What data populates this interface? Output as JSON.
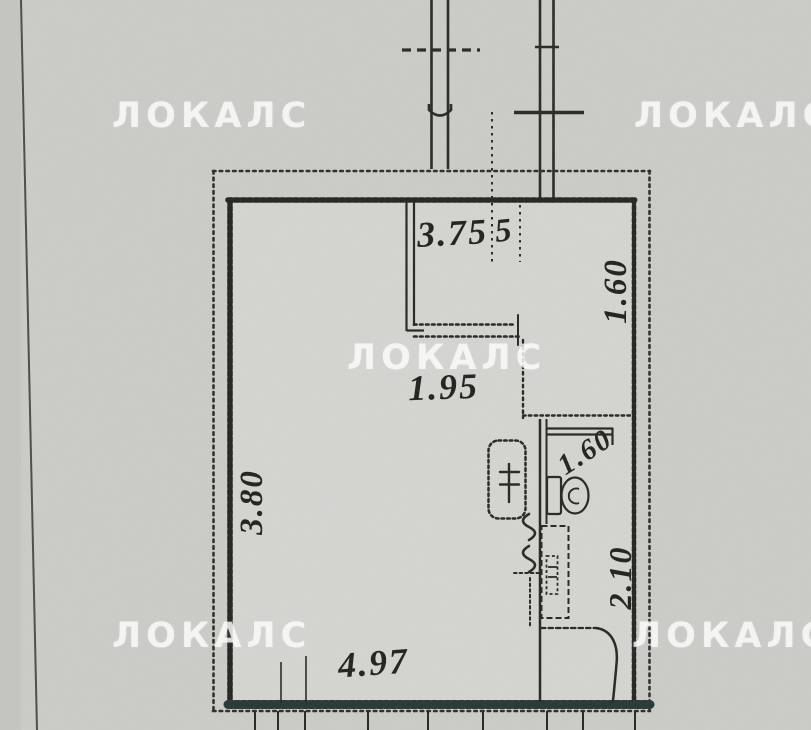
{
  "watermark": {
    "text": "ЛОКАЛС"
  },
  "dims": {
    "top_niche": "3.75",
    "niche_digit": "5",
    "closet_depth": "1.60",
    "passage": "1.95",
    "room_depth": "3.80",
    "room_width": "4.97",
    "wc_width": "1.60",
    "bath_depth": "2.10"
  },
  "colors": {
    "paper": "#cbcbc7",
    "ink": "#1d1d19",
    "wall": "#22231e",
    "bottom_wall": "#263331",
    "watermark": "rgba(255,255,255,0.78)"
  }
}
